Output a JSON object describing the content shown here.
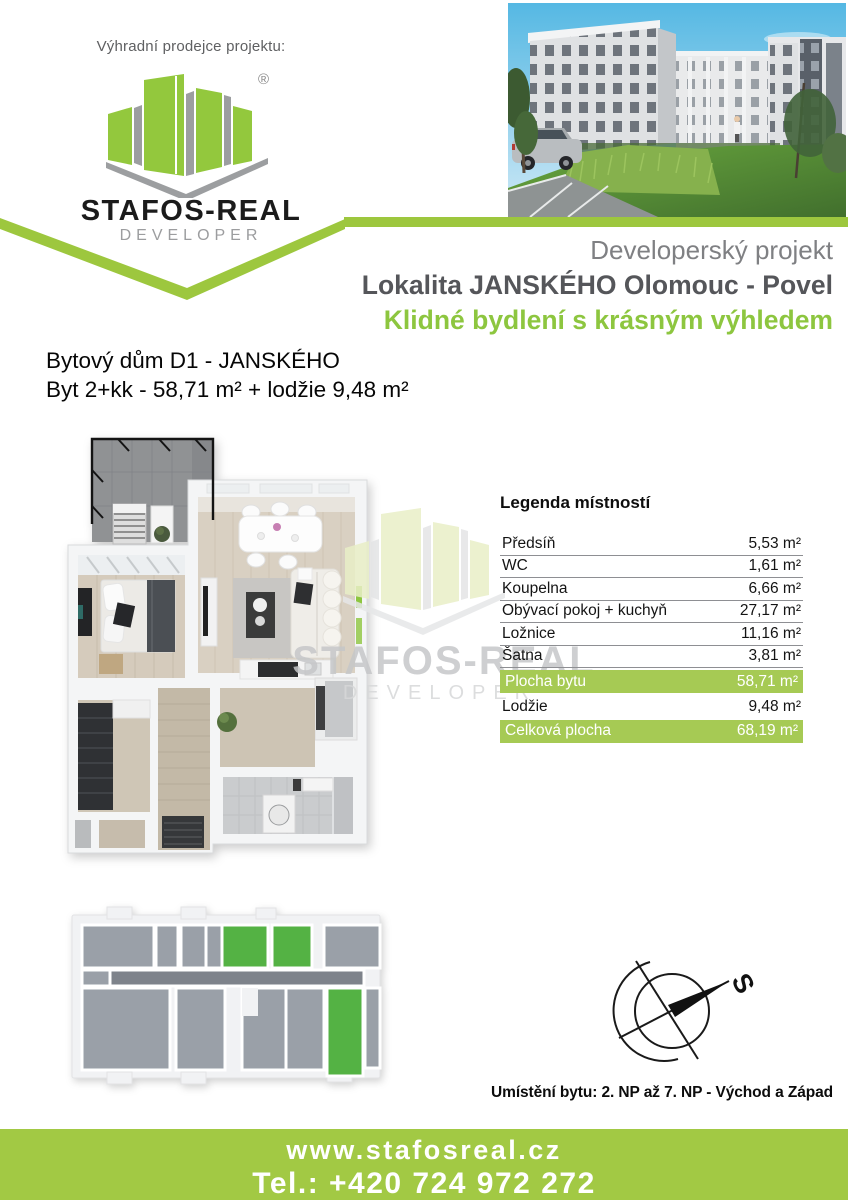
{
  "colors": {
    "brand_green": "#9dc73e",
    "headline_green": "#8dc63f",
    "table_row_green": "#a6ca54",
    "footer_green": "#a2c944",
    "unit_highlight_green": "#54b244",
    "dark_text": "#55565a",
    "gray_text": "#7f8083"
  },
  "seller": {
    "label": "Výhradní prodejce projektu:",
    "brand": "STAFOS-REAL",
    "subtitle": "DEVELOPER",
    "registered": "®"
  },
  "project": {
    "line1": "Developerský projekt",
    "line2": "Lokalita JANSKÉHO Olomouc - Povel",
    "line3": "Klidné bydlení s krásným výhledem"
  },
  "apartment": {
    "building": "Bytový dům D1 - JANSKÉHO",
    "unit": "Byt 2+kk - 58,71 m² + lodžie 9,48 m²"
  },
  "legend": {
    "title": "Legenda místností",
    "rows": [
      {
        "label": "Předsíň",
        "value": "5,53 m²",
        "highlight": false
      },
      {
        "label": "WC",
        "value": "1,61 m²",
        "highlight": false
      },
      {
        "label": "Koupelna",
        "value": "6,66 m²",
        "highlight": false
      },
      {
        "label": "Obývací pokoj + kuchyň",
        "value": "27,17 m²",
        "highlight": false
      },
      {
        "label": "Ložnice",
        "value": "11,16 m²",
        "highlight": false
      },
      {
        "label": "Šatna",
        "value": "3,81 m²",
        "highlight": false
      },
      {
        "label": "Plocha bytu",
        "value": "58,71 m²",
        "highlight": true
      },
      {
        "label": "Lodžie",
        "value": "9,48 m²",
        "highlight": false
      },
      {
        "label": "Celková plocha",
        "value": "68,19 m²",
        "highlight": true
      }
    ]
  },
  "watermark": {
    "brand": "STAFOS-REAL",
    "subtitle": "DEVELOPER"
  },
  "compass": {
    "north": "S"
  },
  "placement": {
    "text": "Umístění bytu: 2. NP až 7. NP - Východ a Západ"
  },
  "footer": {
    "website": "www.stafosreal.cz",
    "phone": "Tel.: +420 724 972 272"
  }
}
